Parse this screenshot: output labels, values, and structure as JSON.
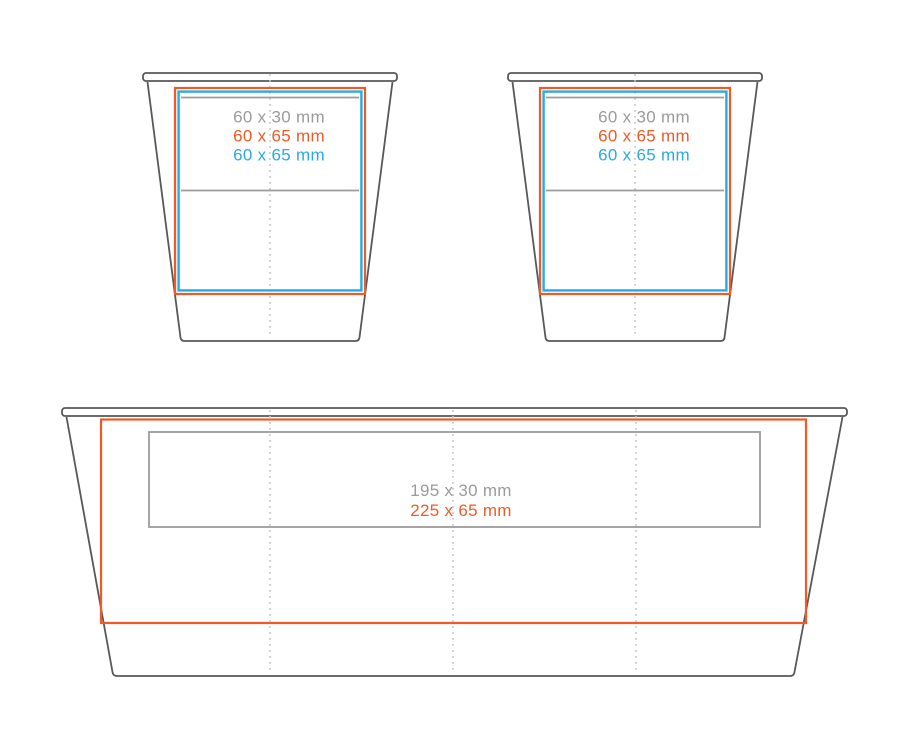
{
  "colors": {
    "outline": "#57585a",
    "print_gray": "#9b9b9b",
    "print_orange": "#f15a24",
    "print_blue": "#29abe2",
    "guide": "#c4c4c4",
    "background": "#ffffff"
  },
  "cup1": {
    "label_gray": "60 x 30 mm",
    "label_orange": "60 x 65 mm",
    "label_blue": "60 x 65 mm"
  },
  "cup2": {
    "label_gray": "60 x 30 mm",
    "label_orange": "60 x 65 mm",
    "label_blue": "60 x 65 mm"
  },
  "tray": {
    "label_gray": "195 x 30 mm",
    "label_orange": "225 x 65 mm"
  }
}
